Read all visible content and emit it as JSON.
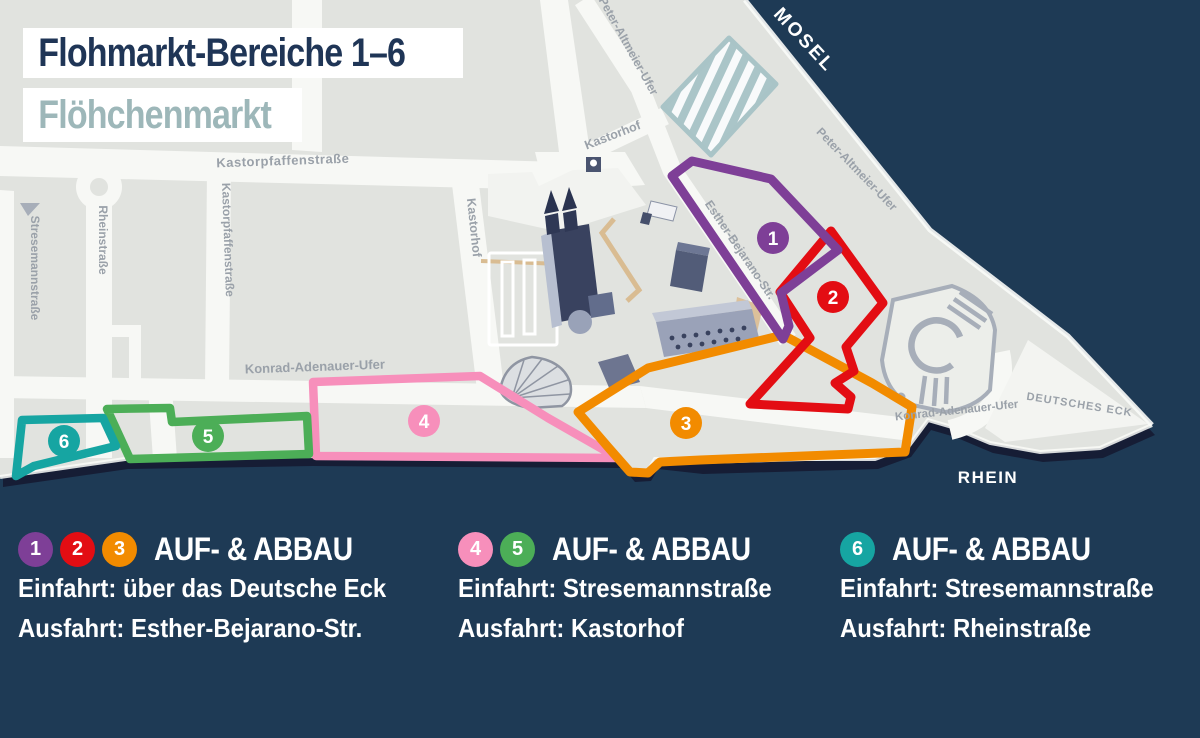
{
  "header": {
    "title": "Flohmarkt-Bereiche 1–6",
    "subtitle": "Flöhchenmarkt"
  },
  "colors": {
    "background_water": "#1e3a55",
    "land": "#e1e3df",
    "street": "#f7f8f5",
    "street_label": "#9aa1a9",
    "title": "#1f3556",
    "subtitle": "#9db7b9",
    "legend_text": "#ffffff",
    "hatched_area": "#aac5c8"
  },
  "map": {
    "labels": {
      "mosel": "MOSEL",
      "rhein": "RHEIN",
      "deutsches_eck": "DEUTSCHES ECK",
      "kastorpfaffenstrasse_top": "Kastorpfaffenstraße",
      "kastorpfaffenstrasse_side": "Kastorpfaffenstraße",
      "stresemannstrasse": "Stresemannstraße",
      "rheinstrasse": "Rheinstraße",
      "kastorhof_side": "Kastorhof",
      "kastorhof_diag": "Kastorhof",
      "peter_altmeier_ufer_1": "Peter-Altmeier-Ufer",
      "peter_altmeier_ufer_2": "Peter-Altmeier-Ufer",
      "esther_bejarano_str": "Esther-Bejarano-Str.",
      "konrad_adenauer_ufer_1": "Konrad-Adenauer-Ufer",
      "konrad_adenauer_ufer_2": "Konrad-Adenauer-Ufer"
    },
    "areas": [
      {
        "number": "1",
        "color": "#7e3f97"
      },
      {
        "number": "2",
        "color": "#e30d13"
      },
      {
        "number": "3",
        "color": "#f28b00"
      },
      {
        "number": "4",
        "color": "#f78fbb"
      },
      {
        "number": "5",
        "color": "#4cae57"
      },
      {
        "number": "6",
        "color": "#16a5a2"
      }
    ]
  },
  "legend": {
    "groups": [
      {
        "badges": [
          "1",
          "2",
          "3"
        ],
        "title": "AUF- & ABBAU",
        "entry": "Einfahrt: über das Deutsche Eck",
        "exit": "Ausfahrt: Esther-Bejarano-Str."
      },
      {
        "badges": [
          "4",
          "5"
        ],
        "title": "AUF- & ABBAU",
        "entry": "Einfahrt: Stresemannstraße",
        "exit": "Ausfahrt: Kastorhof"
      },
      {
        "badges": [
          "6"
        ],
        "title": "AUF- & ABBAU",
        "entry": "Einfahrt: Stresemannstraße",
        "exit": "Ausfahrt: Rheinstraße"
      }
    ]
  }
}
